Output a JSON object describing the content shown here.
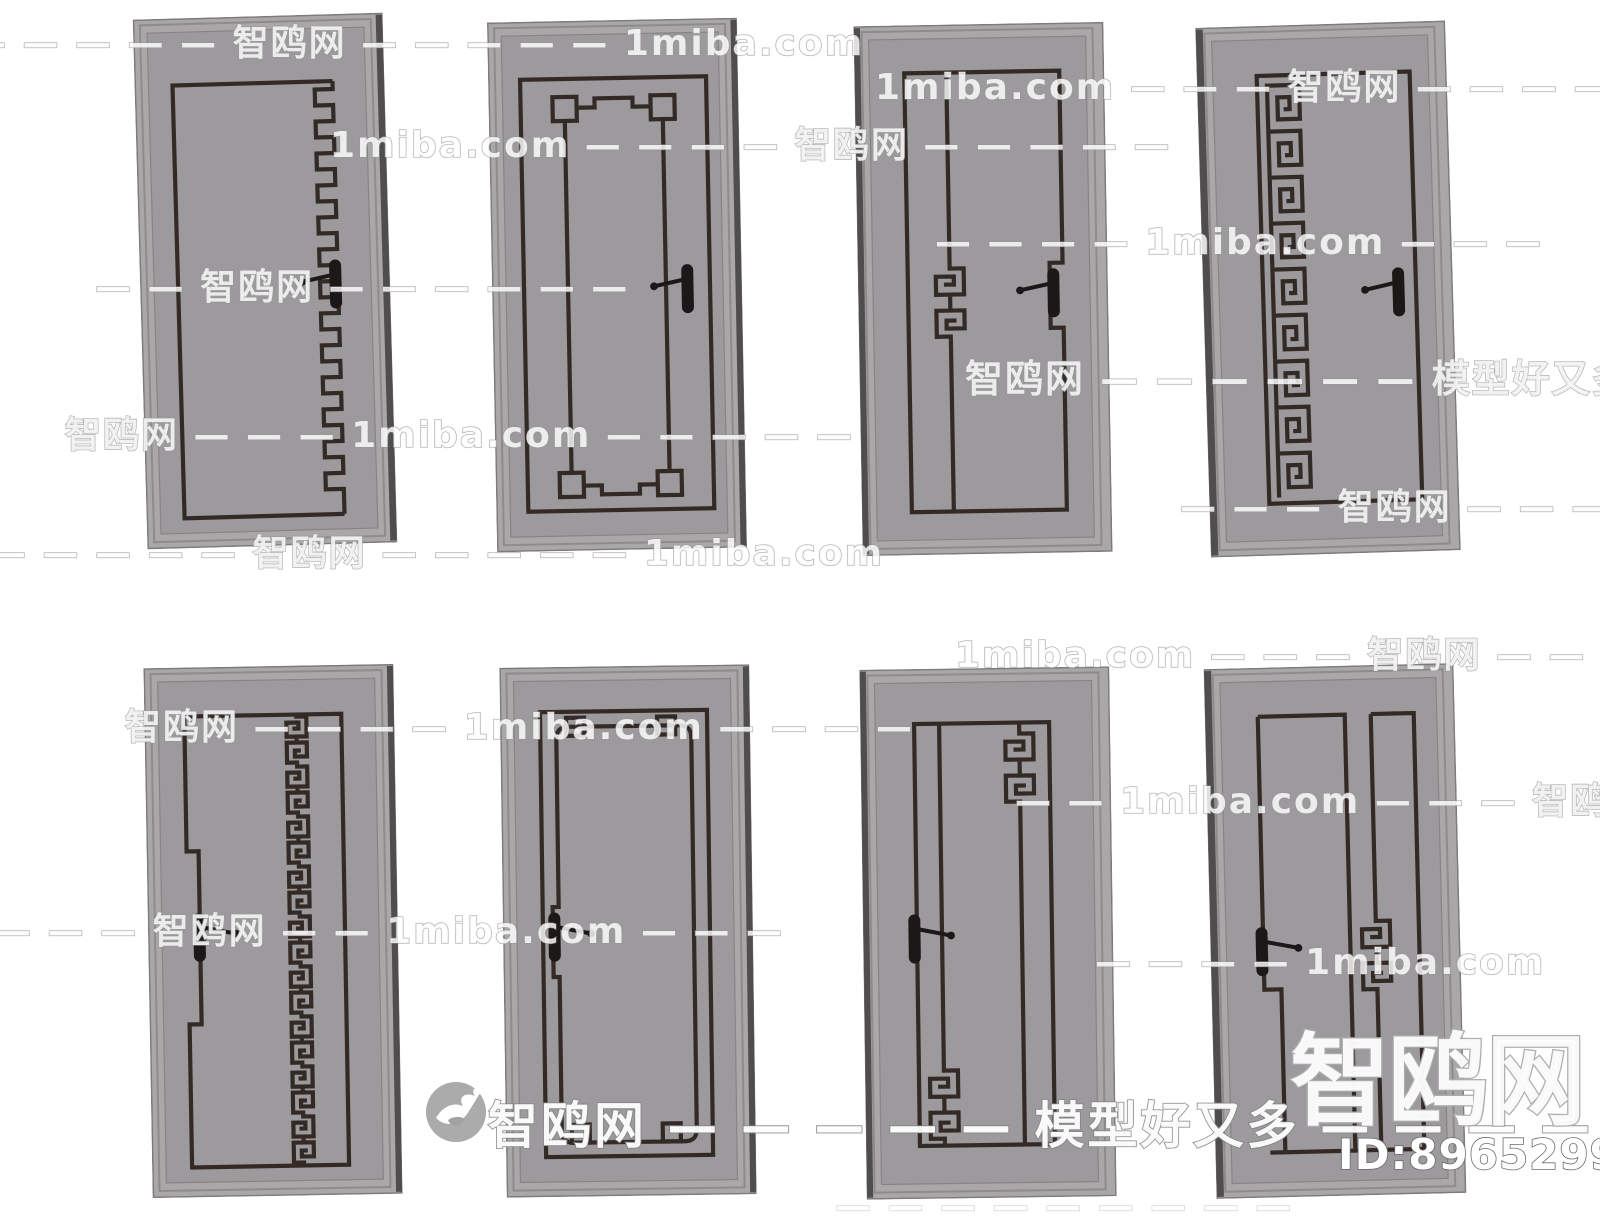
{
  "page": {
    "width": 1600,
    "height": 1214,
    "background": "#ffffff",
    "description": "Product preview sheet of eight Chinese-style interior doors, two rows of four, grey panels with dark meander line ornaments"
  },
  "brand": {
    "site_name_cn": "智鸥网",
    "site_domain": "1miba.com",
    "slogan": "模型好又多",
    "big_logo_text": "智鸥网",
    "model_id_label": "ID:896529917",
    "bird_logo_icon": "seagull-in-circle"
  },
  "colors": {
    "background": "#ffffff",
    "door_frame": "#a9a7a8",
    "door_panel": "#9c9a9c",
    "pattern_line": "#332a26",
    "door_side_shadow": "#504d4e",
    "handle": "#1c1817",
    "watermark_outline": "#969696",
    "id_text_fill": "#ffffff"
  },
  "doors": [
    {
      "id": "door-1",
      "row": 1,
      "col": 1,
      "pattern": "inner border with stepped zigzag right edge",
      "handle_side": "right"
    },
    {
      "id": "door-2",
      "row": 1,
      "col": 2,
      "pattern": "double frame with four corner squares",
      "handle_side": "right"
    },
    {
      "id": "door-3",
      "row": 1,
      "col": 3,
      "pattern": "offset vertical line with central meander knot, notched right line",
      "handle_side": "right"
    },
    {
      "id": "door-4",
      "row": 1,
      "col": 4,
      "pattern": "frame with greek-key meander column on left",
      "handle_side": "right"
    },
    {
      "id": "door-5",
      "row": 2,
      "col": 1,
      "pattern": "frame with central vertical meander chain, jogged left line",
      "handle_side": "left"
    },
    {
      "id": "door-6",
      "row": 2,
      "col": 2,
      "pattern": "rounded inner frame with corner squares",
      "handle_side": "left"
    },
    {
      "id": "door-7",
      "row": 2,
      "col": 3,
      "pattern": "twin vertical lines with meander knots top and bottom",
      "handle_side": "left"
    },
    {
      "id": "door-8",
      "row": 2,
      "col": 4,
      "pattern": "split tall panels, narrow band with meander knot",
      "handle_side": "left"
    }
  ],
  "watermarks": {
    "bottom_row": {
      "text": "智鸥网 — — — — — 模型好又多 — — — — — —"
    },
    "segments": [
      {
        "text": "— — — — — 智鸥网 — — — — — 1miba.com",
        "x": -30,
        "y": 14,
        "size": 36,
        "faint": false
      },
      {
        "text": "1miba.com — — — 智鸥网 — — — — 1miba.com — —",
        "x": 875,
        "y": 58,
        "size": 36,
        "faint": false
      },
      {
        "text": "1miba.com — — — — 智鸥网 — — — — —",
        "x": 330,
        "y": 116,
        "size": 36,
        "faint": false
      },
      {
        "text": "— — — — 1miba.com — — —",
        "x": 935,
        "y": 222,
        "size": 36,
        "faint": false
      },
      {
        "text": "— — 智鸥网 — — — — — —",
        "x": 95,
        "y": 258,
        "size": 36,
        "faint": false
      },
      {
        "text": "智鸥网 — — — — — — 模型好又多 — — — —",
        "x": 965,
        "y": 348,
        "size": 38,
        "faint": false
      },
      {
        "text": "智鸥网 — — — 1miba.com — — — — —",
        "x": 65,
        "y": 406,
        "size": 36,
        "faint": false
      },
      {
        "text": "— — — 智鸥网 — — — — 1miba",
        "x": 1180,
        "y": 478,
        "size": 36,
        "faint": false
      },
      {
        "text": "— — — — — 智鸥网 — — — — — 1miba.com",
        "x": -10,
        "y": 524,
        "size": 36,
        "faint": false
      },
      {
        "text": "1miba.com — — — 智鸥网 — — — 1miba.com",
        "x": 955,
        "y": 626,
        "size": 36,
        "faint": false
      },
      {
        "text": "智鸥网 — — — — 1miba.com — — — —",
        "x": 125,
        "y": 698,
        "size": 36,
        "faint": false
      },
      {
        "text": "— — 1miba.com — — — 智鸥网 — — —",
        "x": 1015,
        "y": 772,
        "size": 36,
        "faint": false
      },
      {
        "text": "— — — 智鸥网 — — 1miba.com — — —",
        "x": -5,
        "y": 902,
        "size": 36,
        "faint": false
      },
      {
        "text": "— — — — 1miba.com",
        "x": 1095,
        "y": 942,
        "size": 36,
        "faint": false
      },
      {
        "text": "— — — — — — — — —",
        "x": 835,
        "y": 1186,
        "size": 36,
        "faint": true
      }
    ]
  }
}
